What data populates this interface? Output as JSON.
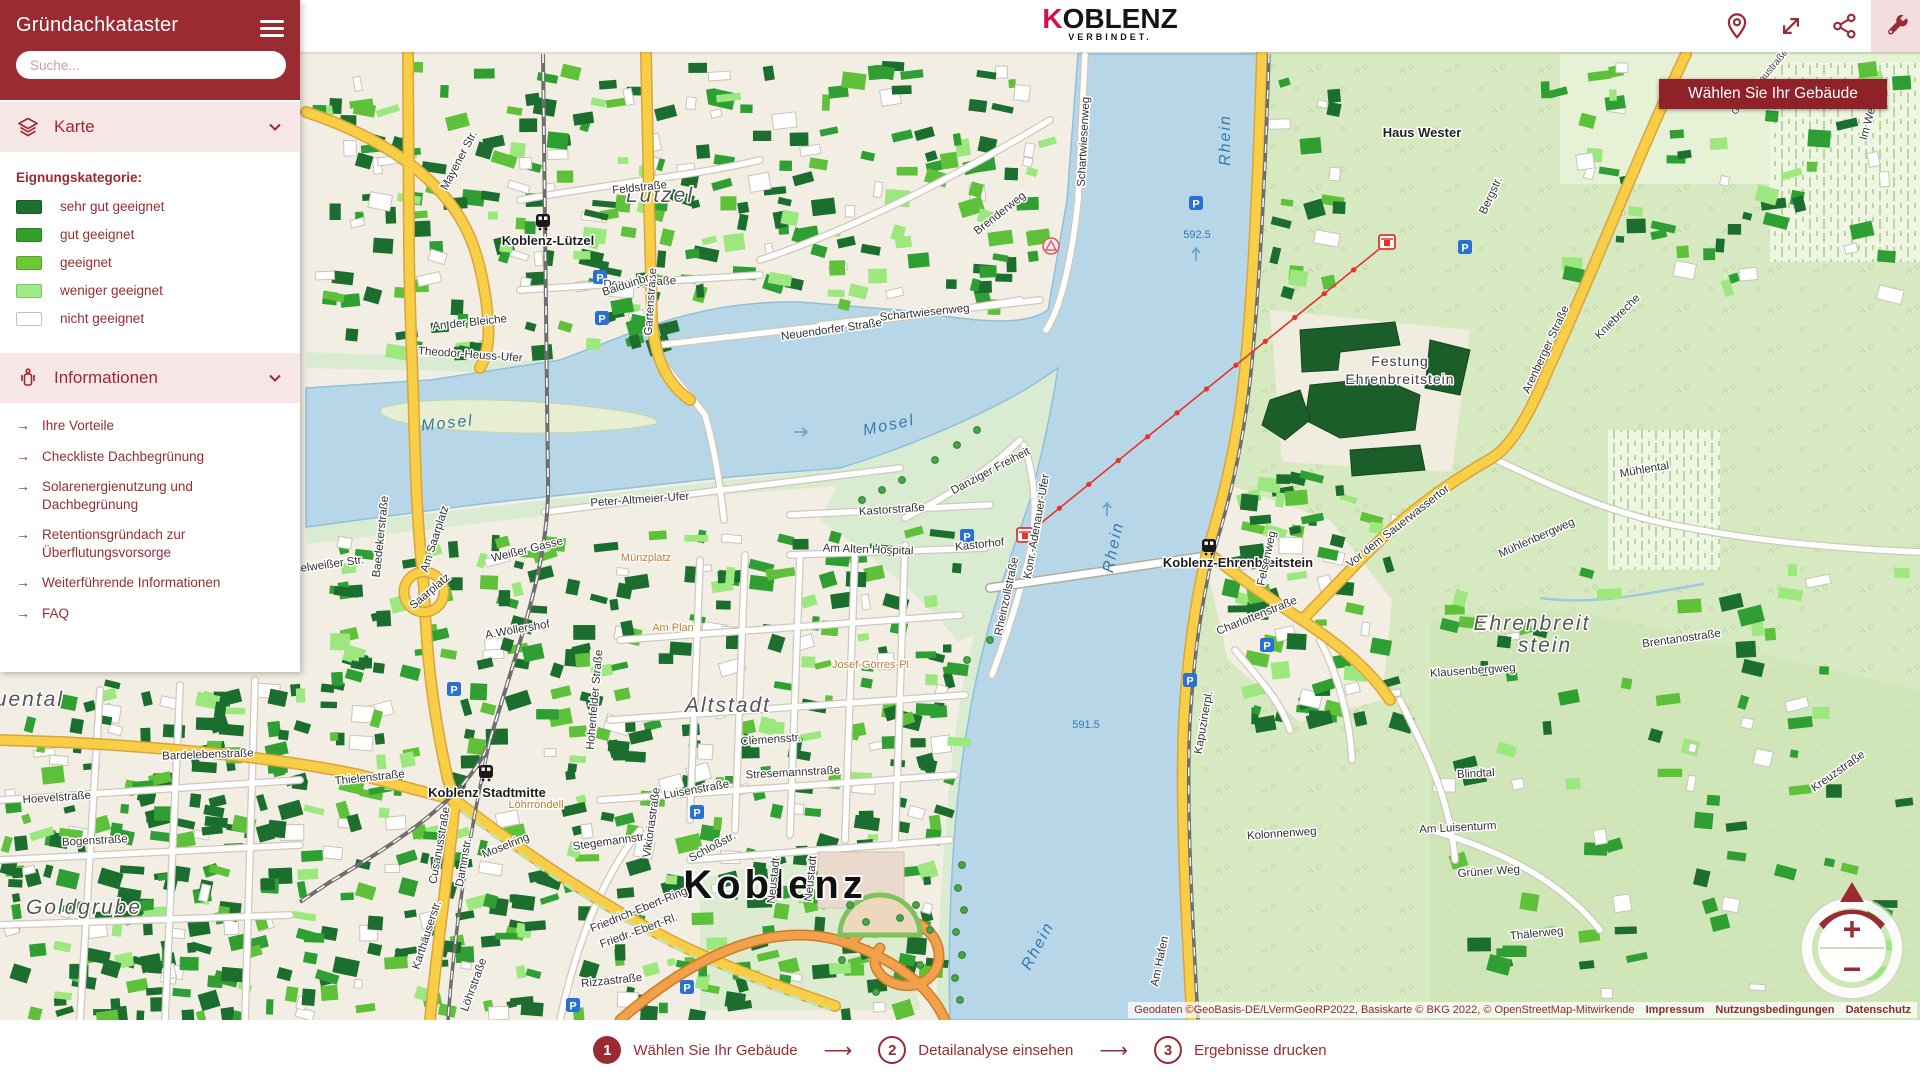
{
  "colors": {
    "accent": "#9a2b33",
    "logo_red": "#d40f4d",
    "water": "#b7d7e9",
    "legend": [
      "#1a7130",
      "#33a02c",
      "#6cc832",
      "#9dec85",
      "#ffffff"
    ]
  },
  "app": {
    "title": "Gründachkataster"
  },
  "sidebar": {
    "search_placeholder": "Suche...",
    "section_karte": "Karte",
    "section_info": "Informationen",
    "legend_title": "Eignungskategorie:",
    "legend": [
      {
        "label": "sehr gut geeignet",
        "color": "#1a7130"
      },
      {
        "label": "gut geeignet",
        "color": "#33a02c"
      },
      {
        "label": "geeignet",
        "color": "#6cc832"
      },
      {
        "label": "weniger geeignet",
        "color": "#9dec85"
      },
      {
        "label": "nicht geeignet",
        "color": "#ffffff"
      }
    ],
    "links": [
      "Ihre Vorteile",
      "Checkliste Dachbegrünung",
      "Solarenergienutzung und Dachbegrünung",
      "Retentionsgründach zur Überflutungsvorsorge",
      "Weiterführende Informationen",
      "FAQ"
    ]
  },
  "header": {
    "logo_k": "K",
    "logo_rest": "OBLENZ",
    "logo_sub": "VERBINDET."
  },
  "tooltip": "Wählen Sie Ihr Gebäude",
  "stepper": [
    {
      "num": "1",
      "label": "Wählen Sie Ihr Gebäude"
    },
    {
      "num": "2",
      "label": "Detailanalyse einsehen"
    },
    {
      "num": "3",
      "label": "Ergebnisse drucken"
    }
  ],
  "stepper_arrow": "⟶",
  "attribution": {
    "text": "Geodaten ©GeoBasis-DE/LVermGeoRP2022, Basiskarte © BKG 2022, © OpenStreetMap-Mitwirkende",
    "links": [
      "Impressum",
      "Nutzungsbedingungen",
      "Datenschutz"
    ]
  },
  "zoom_control": {
    "plus": "+",
    "minus": "−"
  },
  "map": {
    "labels": [
      {
        "t": "Koblenz",
        "x": 775,
        "y": 898,
        "r": 0,
        "c": "city"
      },
      {
        "t": "Lützel",
        "x": 660,
        "y": 202,
        "r": 0,
        "c": "dist"
      },
      {
        "t": "Altstadt",
        "x": 728,
        "y": 712,
        "r": 0,
        "c": "dist"
      },
      {
        "t": "Ehrenbreit",
        "x": 1532,
        "y": 630,
        "r": 0,
        "c": "dist"
      },
      {
        "t": "stein",
        "x": 1545,
        "y": 652,
        "r": 0,
        "c": "dist"
      },
      {
        "t": "Rauental",
        "x": 14,
        "y": 706,
        "r": 0,
        "c": "dist"
      },
      {
        "t": "Goldgrube",
        "x": 84,
        "y": 914,
        "r": 0,
        "c": "dist"
      },
      {
        "t": "Mosel",
        "x": 448,
        "y": 428,
        "r": -6,
        "c": "wat"
      },
      {
        "t": "Mosel",
        "x": 890,
        "y": 430,
        "r": -12,
        "c": "wat"
      },
      {
        "t": "Rhein",
        "x": 1230,
        "y": 140,
        "r": -90,
        "c": "wat"
      },
      {
        "t": "Rhein",
        "x": 1118,
        "y": 548,
        "r": -78,
        "c": "wat"
      },
      {
        "t": "Rhein",
        "x": 1042,
        "y": 948,
        "r": -62,
        "c": "wat"
      },
      {
        "t": "592.5",
        "x": 1197,
        "y": 238,
        "r": 0,
        "c": "watsm"
      },
      {
        "t": "591.5",
        "x": 1086,
        "y": 728,
        "r": 0,
        "c": "watsm"
      },
      {
        "t": "Koblenz-Lützel",
        "x": 548,
        "y": 245,
        "r": 0,
        "c": "stn"
      },
      {
        "t": "Koblenz Stadtmitte",
        "x": 487,
        "y": 797,
        "r": 0,
        "c": "stn"
      },
      {
        "t": "Koblenz-Ehrenbreitstein",
        "x": 1238,
        "y": 567,
        "r": 0,
        "c": "stn"
      },
      {
        "t": "Haus Wester",
        "x": 1422,
        "y": 137,
        "r": 0,
        "c": "pl"
      },
      {
        "t": "Festung",
        "x": 1400,
        "y": 366,
        "r": 0,
        "c": "pl2"
      },
      {
        "t": "Ehrenbreitstein",
        "x": 1400,
        "y": 384,
        "r": 0,
        "c": "pl2"
      },
      {
        "t": "Münzplatz",
        "x": 646,
        "y": 561,
        "r": 0,
        "c": "org"
      },
      {
        "t": "Am Plan",
        "x": 673,
        "y": 631,
        "r": 0,
        "c": "org"
      },
      {
        "t": "Löhrrondell",
        "x": 536,
        "y": 808,
        "r": 0,
        "c": "org"
      },
      {
        "t": "Josef-Görres-Pl.",
        "x": 872,
        "y": 668,
        "r": 0,
        "c": "org"
      },
      {
        "t": "Mayener Str.",
        "x": 462,
        "y": 162,
        "r": -62,
        "c": "st"
      },
      {
        "t": "Feldstraße",
        "x": 640,
        "y": 191,
        "r": -6,
        "c": "st"
      },
      {
        "t": "Douquestraße",
        "x": 640,
        "y": 286,
        "r": -3,
        "c": "st"
      },
      {
        "t": "Gartenstraße",
        "x": 654,
        "y": 302,
        "r": -86,
        "c": "st"
      },
      {
        "t": "Balduinbr.",
        "x": 628,
        "y": 288,
        "r": -18,
        "c": "st"
      },
      {
        "t": "Neuendorfer Straße",
        "x": 832,
        "y": 333,
        "r": -8,
        "c": "st"
      },
      {
        "t": "Brenderweg",
        "x": 1002,
        "y": 216,
        "r": -38,
        "c": "st"
      },
      {
        "t": "Schartwiesenweg",
        "x": 1087,
        "y": 142,
        "r": -87,
        "c": "st"
      },
      {
        "t": "Schartwiesenweg",
        "x": 925,
        "y": 316,
        "r": -6,
        "c": "st"
      },
      {
        "t": "An der Bleiche",
        "x": 470,
        "y": 326,
        "r": -6,
        "c": "st"
      },
      {
        "t": "Theodor-Heuss-Ufer",
        "x": 470,
        "y": 358,
        "r": 4,
        "c": "st"
      },
      {
        "t": "Peter-Altmeier-Ufer",
        "x": 640,
        "y": 503,
        "r": -4,
        "c": "st"
      },
      {
        "t": "Kastorstraße",
        "x": 892,
        "y": 513,
        "r": -4,
        "c": "st"
      },
      {
        "t": "Am Alten Hospital",
        "x": 868,
        "y": 553,
        "r": 2,
        "c": "st"
      },
      {
        "t": "Danziger Freiheit",
        "x": 992,
        "y": 474,
        "r": -28,
        "c": "st"
      },
      {
        "t": "Konr.-Adenauer-Ufer",
        "x": 1040,
        "y": 527,
        "r": -80,
        "c": "st"
      },
      {
        "t": "Rheinzollstraße",
        "x": 1010,
        "y": 597,
        "r": -78,
        "c": "st"
      },
      {
        "t": "Kastorhof",
        "x": 980,
        "y": 548,
        "r": -6,
        "c": "st"
      },
      {
        "t": "Weißer Gasse",
        "x": 528,
        "y": 553,
        "r": -14,
        "c": "st"
      },
      {
        "t": "Am Saarplatz",
        "x": 438,
        "y": 540,
        "r": -72,
        "c": "st"
      },
      {
        "t": "Baedekerstraße",
        "x": 384,
        "y": 537,
        "r": -84,
        "c": "st"
      },
      {
        "t": "Moselweißer Str.",
        "x": 322,
        "y": 569,
        "r": -8,
        "c": "st"
      },
      {
        "t": "Saarplatz",
        "x": 432,
        "y": 594,
        "r": -40,
        "c": "st"
      },
      {
        "t": "A.Wöllershof",
        "x": 518,
        "y": 633,
        "r": -10,
        "c": "st"
      },
      {
        "t": "Hohenfelder Straße",
        "x": 598,
        "y": 700,
        "r": -85,
        "c": "st"
      },
      {
        "t": "Löhrstraße",
        "x": 477,
        "y": 986,
        "r": -70,
        "c": "st"
      },
      {
        "t": "Moselring",
        "x": 507,
        "y": 849,
        "r": -22,
        "c": "st"
      },
      {
        "t": "Friedrich-Ebert-Ring",
        "x": 640,
        "y": 913,
        "r": -22,
        "c": "st"
      },
      {
        "t": "Friedr.-Ebert-Rl.",
        "x": 640,
        "y": 934,
        "r": -20,
        "c": "st"
      },
      {
        "t": "Cusanusstraße",
        "x": 443,
        "y": 846,
        "r": -80,
        "c": "st"
      },
      {
        "t": "Karthäuserstr.",
        "x": 430,
        "y": 936,
        "r": -72,
        "c": "st"
      },
      {
        "t": "Rizzastraße",
        "x": 612,
        "y": 984,
        "r": -6,
        "c": "st"
      },
      {
        "t": "Viktoriastraße",
        "x": 655,
        "y": 823,
        "r": -82,
        "c": "st"
      },
      {
        "t": "Luisenstraße",
        "x": 697,
        "y": 793,
        "r": -10,
        "c": "st"
      },
      {
        "t": "Stegemannstr.",
        "x": 610,
        "y": 845,
        "r": -8,
        "c": "st"
      },
      {
        "t": "Schloßstr.",
        "x": 714,
        "y": 850,
        "r": -28,
        "c": "st"
      },
      {
        "t": "Neustadt",
        "x": 777,
        "y": 881,
        "r": -84,
        "c": "st"
      },
      {
        "t": "Neustadt",
        "x": 814,
        "y": 879,
        "r": -84,
        "c": "st"
      },
      {
        "t": "Clemensstr.",
        "x": 771,
        "y": 743,
        "r": -4,
        "c": "st"
      },
      {
        "t": "Stresemannstraße",
        "x": 793,
        "y": 776,
        "r": -3,
        "c": "st"
      },
      {
        "t": "Dammstr.",
        "x": 467,
        "y": 863,
        "r": -80,
        "c": "st"
      },
      {
        "t": "Hoevelstraße",
        "x": 57,
        "y": 801,
        "r": -4,
        "c": "st"
      },
      {
        "t": "Bogenstraße",
        "x": 95,
        "y": 844,
        "r": -3,
        "c": "st"
      },
      {
        "t": "Bardelebenstraße",
        "x": 208,
        "y": 758,
        "r": -2,
        "c": "st"
      },
      {
        "t": "Thielenstraße",
        "x": 370,
        "y": 781,
        "r": -6,
        "c": "st"
      },
      {
        "t": "Charlottenstraße",
        "x": 1258,
        "y": 619,
        "r": -22,
        "c": "st"
      },
      {
        "t": "Felsenweg",
        "x": 1270,
        "y": 559,
        "r": -78,
        "c": "st"
      },
      {
        "t": "Kapuzinerpl.",
        "x": 1207,
        "y": 723,
        "r": -80,
        "c": "st"
      },
      {
        "t": "Kolonnenweg",
        "x": 1282,
        "y": 837,
        "r": -4,
        "c": "st"
      },
      {
        "t": "Am Luisenturm",
        "x": 1458,
        "y": 831,
        "r": -3,
        "c": "st"
      },
      {
        "t": "Grüner Weg",
        "x": 1489,
        "y": 875,
        "r": -4,
        "c": "st"
      },
      {
        "t": "Thälerweg",
        "x": 1537,
        "y": 937,
        "r": -6,
        "c": "st"
      },
      {
        "t": "Blindtal",
        "x": 1476,
        "y": 777,
        "r": -3,
        "c": "st"
      },
      {
        "t": "Klausenbergweg",
        "x": 1473,
        "y": 674,
        "r": -4,
        "c": "st"
      },
      {
        "t": "Kreuzstraße",
        "x": 1840,
        "y": 774,
        "r": -35,
        "c": "st"
      },
      {
        "t": "Brentanostraße",
        "x": 1682,
        "y": 642,
        "r": -8,
        "c": "st"
      },
      {
        "t": "Mühlental",
        "x": 1645,
        "y": 473,
        "r": -10,
        "c": "st"
      },
      {
        "t": "Mühlenbergweg",
        "x": 1538,
        "y": 541,
        "r": -24,
        "c": "st"
      },
      {
        "t": "Vor dem Sauerwassertor",
        "x": 1400,
        "y": 529,
        "r": -38,
        "c": "st"
      },
      {
        "t": "Arenberger Straße",
        "x": 1549,
        "y": 351,
        "r": -65,
        "c": "st"
      },
      {
        "t": "Kniebreche",
        "x": 1620,
        "y": 319,
        "r": -45,
        "c": "st"
      },
      {
        "t": "Bergstr.",
        "x": 1494,
        "y": 197,
        "r": -65,
        "c": "st"
      },
      {
        "t": "Im Weeling",
        "x": 1874,
        "y": 113,
        "r": -75,
        "c": "st"
      },
      {
        "t": "Am Hafen",
        "x": 1163,
        "y": 962,
        "r": -78,
        "c": "st"
      },
      {
        "t": "Greiffenklaustraße",
        "x": 1762,
        "y": 84,
        "r": -50,
        "c": "stsm"
      }
    ],
    "parking_letter": "P",
    "parking": [
      [
        600,
        277
      ],
      [
        602,
        318
      ],
      [
        967,
        536
      ],
      [
        1196,
        203
      ],
      [
        1465,
        247
      ],
      [
        1267,
        645
      ],
      [
        1190,
        680
      ],
      [
        697,
        812
      ],
      [
        454,
        689
      ],
      [
        687,
        987
      ],
      [
        573,
        1005
      ]
    ],
    "stations": [
      [
        543,
        222
      ],
      [
        486,
        773
      ],
      [
        1209,
        547
      ]
    ],
    "cable_stations": [
      [
        1025,
        535
      ],
      [
        1387,
        242
      ]
    ],
    "cable_line": {
      "x1": 1030,
      "y1": 532,
      "x2": 1383,
      "y2": 246
    }
  }
}
